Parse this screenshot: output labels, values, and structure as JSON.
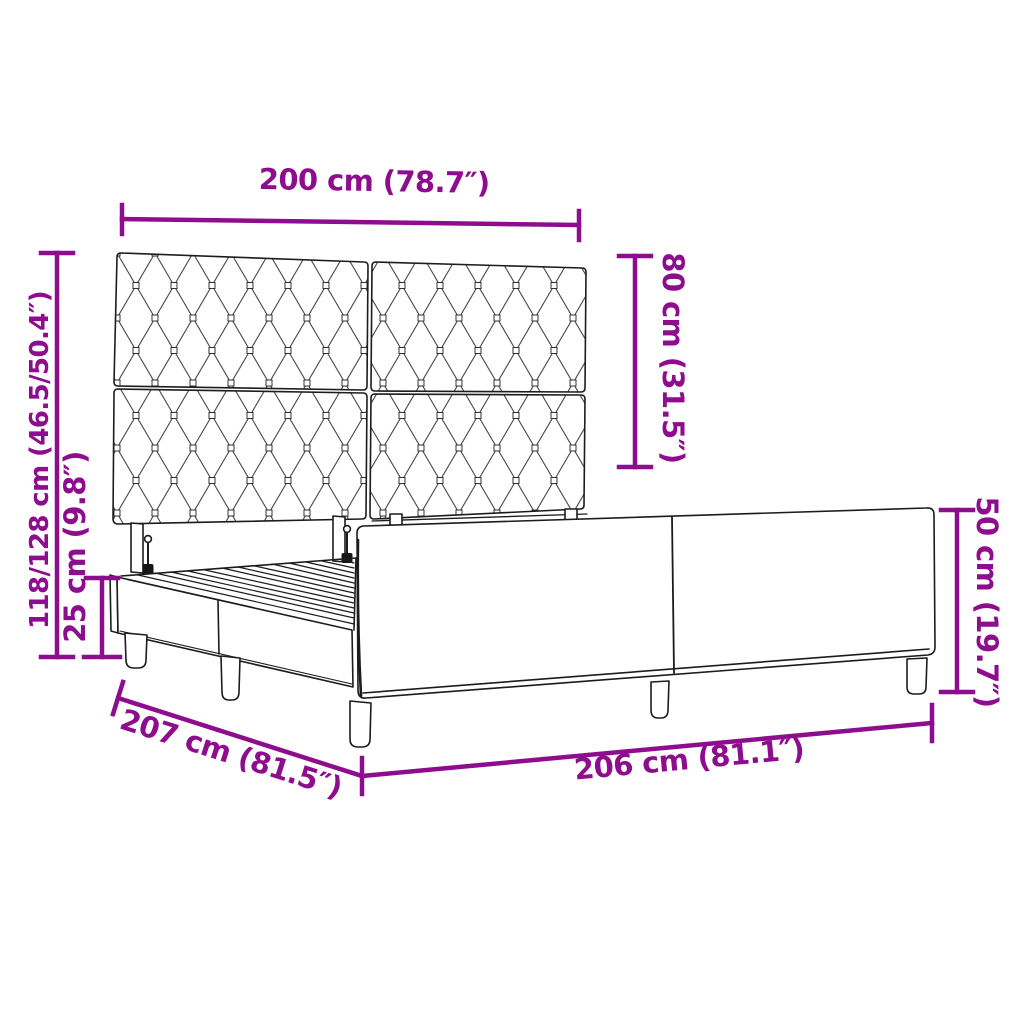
{
  "diagram": {
    "subject": "bed-frame-with-tufted-headboard",
    "accent_color": "#8E0D8E",
    "line_color": "#1c1c1c",
    "background_color": "#ffffff",
    "dimensions": {
      "headboard_width": {
        "label": "200 cm (78.7″)"
      },
      "headboard_panel_height": {
        "label": "80 cm (31.5″)"
      },
      "overall_height": {
        "label": "118/128 cm (46.5/50.4″)"
      },
      "base_rail_height": {
        "label": "25 cm (9.8″)"
      },
      "side_panel_height": {
        "label": "50 cm (19.7″)"
      },
      "frame_length_left": {
        "label": "207 cm (81.5″)"
      },
      "frame_length_right": {
        "label": "206 cm (81.1″)"
      }
    }
  }
}
